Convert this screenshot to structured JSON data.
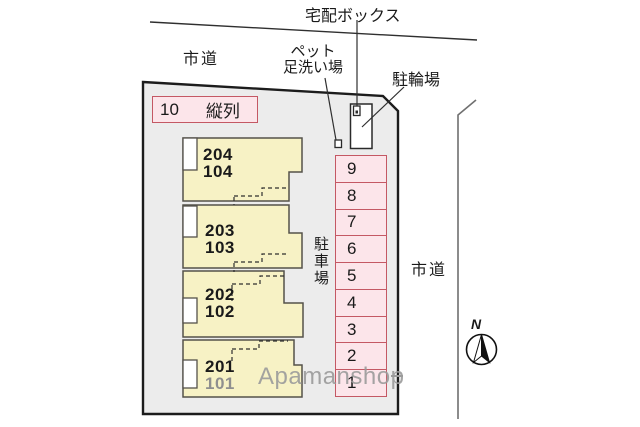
{
  "colors": {
    "site_fill": "#ececec",
    "site_stroke": "#1c1c1c",
    "building_fill": "#f7f2c5",
    "building_stroke": "#55524a",
    "parking_fill": "#fce5ea",
    "parking_stroke": "#c45864",
    "line": "#2f2f2f",
    "road_line": "#707070",
    "text": "#1a1a1a",
    "muted_text": "#8f8f8f",
    "watermark": "#9b9b9b"
  },
  "labels": {
    "delivery_box": "宅配ボックス",
    "city_road_top": "市道",
    "city_road_right": "市道",
    "pet_wash_line1": "ペット",
    "pet_wash_line2": "足洗い場",
    "bicycle_parking": "駐輪場",
    "parking_lot": "駐車場",
    "north": "N",
    "watermark": "Apamanshop"
  },
  "tandem": {
    "count": "10",
    "label": "縦列"
  },
  "building_units": [
    {
      "upper": "204",
      "lower": "104"
    },
    {
      "upper": "203",
      "lower": "103"
    },
    {
      "upper": "202",
      "lower": "102"
    },
    {
      "upper": "201",
      "lower": "101"
    }
  ],
  "parking_spaces": [
    "9",
    "8",
    "7",
    "6",
    "5",
    "4",
    "3",
    "2",
    "1"
  ]
}
